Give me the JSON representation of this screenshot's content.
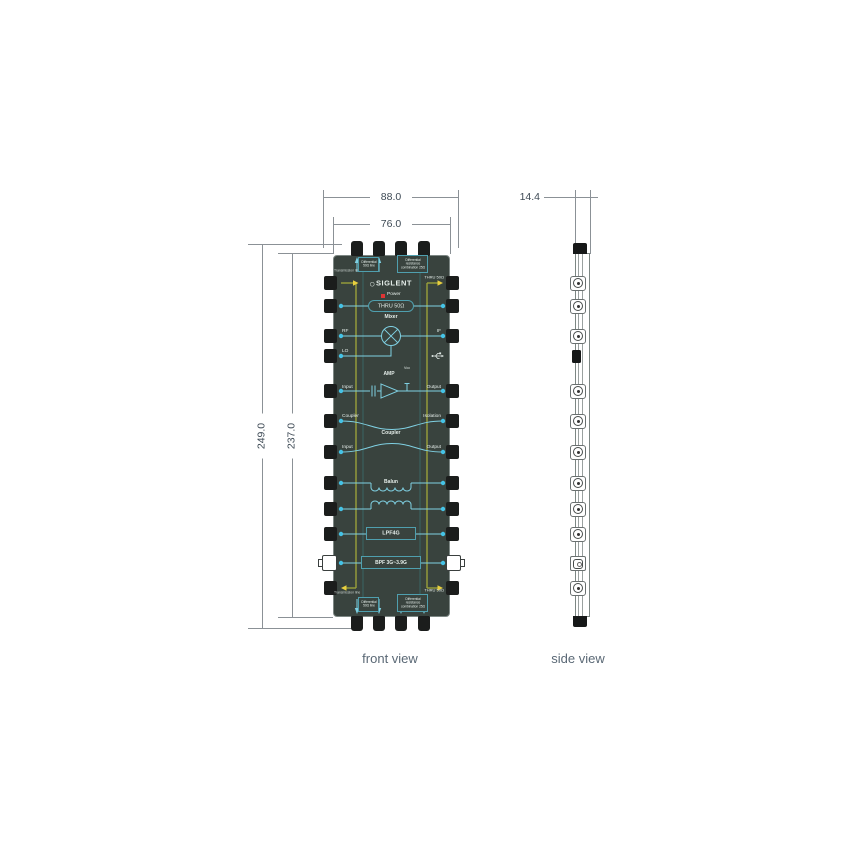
{
  "colors": {
    "pcb": "#39433e",
    "pcb-border": "#7d8784",
    "trace": "#7fd0e2",
    "dot": "#45c3e6",
    "teal": "#4f9fae",
    "yellow": "#9aa03a",
    "arrow": "#e8cf3e",
    "board-text": "#e4ede9",
    "led": "#e03434",
    "line": "#8b9196",
    "dim-text": "#3e4a55",
    "label-text": "#5a6875",
    "connector": "#1b1d1c"
  },
  "views": {
    "front": "front view",
    "side": "side view"
  },
  "dimensions": {
    "outer_width": "88.0",
    "inner_width": "76.0",
    "outer_height": "249.0",
    "inner_height": "237.0",
    "thickness": "14.4"
  },
  "board": {
    "brand": "SIGLENT",
    "power": "Power",
    "thru_label": "THRU 50Ω",
    "corner_top_left": "Transmission line",
    "corner_top_right": "THRU 50Ω",
    "corner_bottom_left": "Transmission line",
    "corner_bottom_right": "THRU 50Ω",
    "diff_line_box": "Differential 50Ω line",
    "diff_res_box": "Differential resistance combination 25Ω",
    "mixer": {
      "title": "Mixer",
      "rf": "RF",
      "lo": "LO",
      "if": "IF"
    },
    "amp": {
      "title": "AMP",
      "vcc": "Vcc",
      "input": "Input",
      "output": "Output"
    },
    "coupler": {
      "title": "Coupler",
      "port": "Coupler",
      "isolation": "Isolation",
      "input": "Input",
      "output": "Output"
    },
    "balun": "Balun",
    "lpf": "LPF4G",
    "bpf": "BPF 3G~3.9G"
  }
}
